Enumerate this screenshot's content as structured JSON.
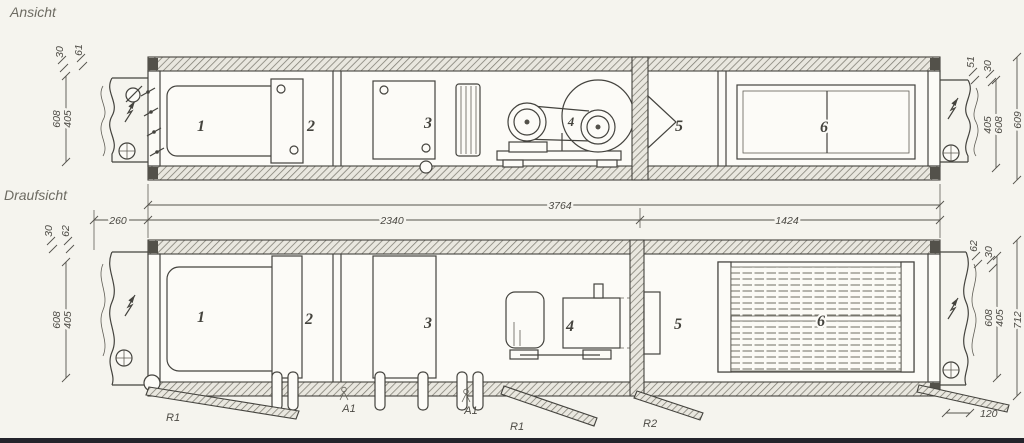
{
  "colors": {
    "paper": "#f5f4ee",
    "ink": "#44433e"
  },
  "front_view": {
    "title": "Ansicht",
    "section_labels": {
      "s1": "1",
      "s2": "2",
      "s3": "3",
      "s4": "4",
      "s5": "5",
      "s6": "6"
    },
    "dims_left": {
      "tick_a": "30",
      "tick_b": "61",
      "h_outer": "608",
      "h_inner": "405"
    },
    "dims_right": {
      "tick_a": "51",
      "tick_b": "30",
      "h_inner": "405",
      "h_outer": "608",
      "total": "609"
    }
  },
  "top_view": {
    "title": "Draufsicht",
    "section_labels": {
      "s1": "1",
      "s2": "2",
      "s3": "3",
      "s4": "4",
      "s5": "5",
      "s6": "6"
    },
    "dims_left": {
      "tick_a": "30",
      "tick_b": "62",
      "w_outer": "608",
      "w_inner": "405"
    },
    "dims_right": {
      "tick_a": "62",
      "tick_b": "30",
      "w_outer": "608",
      "w_inner": "405",
      "total": "712",
      "offset_bottom": "120"
    }
  },
  "length_dims": {
    "overall": "3764",
    "left_segment": "2340",
    "right_segment": "1424",
    "inlet_stub": "260"
  },
  "bottom_labels": {
    "r1_left": "R1",
    "a1_left": "A1",
    "a1_right": "A1",
    "r1_mid": "R1",
    "r2": "R2"
  }
}
